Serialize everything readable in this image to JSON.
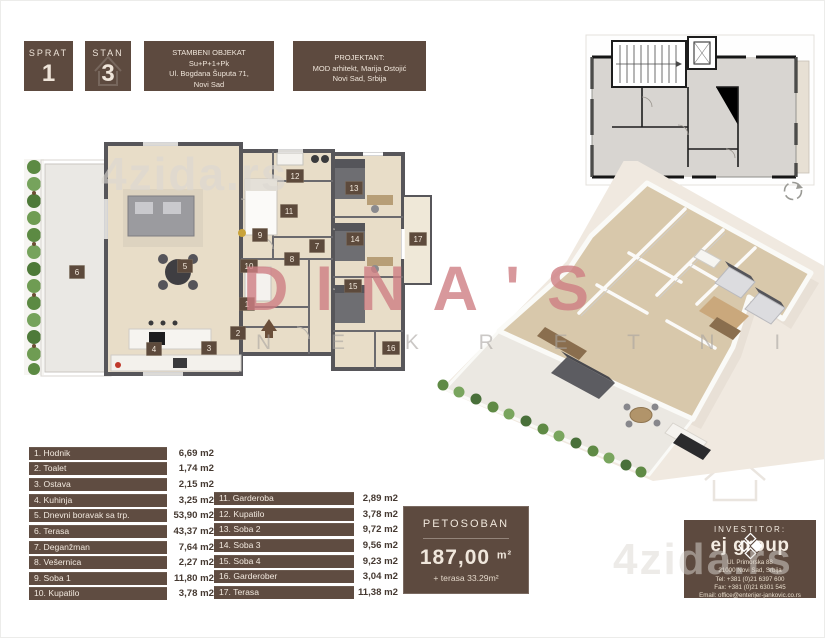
{
  "header": {
    "sprat": {
      "label": "SPRAT",
      "value": "1"
    },
    "stan": {
      "label": "STAN",
      "value": "3"
    },
    "object": {
      "line1": "STAMBENI OBJEKAT",
      "line2": "Su+P+1+Pk",
      "line3": "Ul. Bogdana Šuputa 71,",
      "line4": "Novi Sad"
    },
    "projektant": {
      "line1": "PROJEKTANT:",
      "line2": "MOD arhitekt, Marija Ostojić",
      "line3": "Novi Sad, Srbija"
    }
  },
  "legend": {
    "left": [
      {
        "label": "1. Hodnik",
        "area": "6,69 m2"
      },
      {
        "label": "2. Toalet",
        "area": "1,74 m2"
      },
      {
        "label": "3. Ostava",
        "area": "2,15 m2"
      },
      {
        "label": "4. Kuhinja",
        "area": "3,25 m2"
      },
      {
        "label": "5. Dnevni boravak sa trp.",
        "area": "53,90 m2"
      },
      {
        "label": "6. Terasa",
        "area": "43,37 m2"
      },
      {
        "label": "7. Deganžman",
        "area": "7,64 m2"
      },
      {
        "label": "8. Vešernica",
        "area": "2,27 m2"
      },
      {
        "label": "9. Soba 1",
        "area": "11,80 m2"
      },
      {
        "label": "10. Kupatilo",
        "area": "3,78 m2"
      }
    ],
    "right": [
      {
        "label": "11. Garderoba",
        "area": "2,89 m2"
      },
      {
        "label": "12. Kupatilo",
        "area": "3,78 m2"
      },
      {
        "label": "13. Soba 2",
        "area": "9,72 m2"
      },
      {
        "label": "14. Soba 3",
        "area": "9,56 m2"
      },
      {
        "label": "15. Soba 4",
        "area": "9,23 m2"
      },
      {
        "label": "16. Garderober",
        "area": "3,04 m2"
      },
      {
        "label": "17. Terasa",
        "area": "11,38 m2"
      }
    ]
  },
  "summary": {
    "type_label": "PETOSOBAN",
    "area_value": "187,00",
    "area_unit": "m²",
    "terrace_note": "+ terasa 33.29m²"
  },
  "investor": {
    "title": "INVESTITOR:",
    "brand": "ej group",
    "address": "Ul. Primorska 88",
    "city": "21000 Novi Sad, Srbija",
    "tel": "Tel:  +381 (0)21 6397 600",
    "fax": "Fax:  +381 (0)21 6301 545",
    "email": "Email: office@enterijer-jankovic.co.rs"
  },
  "watermarks": {
    "top": "4zida.rs",
    "brand": "DINA'S",
    "brand_sub": "N E K R E T N I N E",
    "bottom": "4zida.rs"
  },
  "plan2d": {
    "markers": [
      "1",
      "2",
      "3",
      "4",
      "5",
      "6",
      "7",
      "8",
      "9",
      "10",
      "11",
      "12",
      "13",
      "14",
      "15",
      "16",
      "17"
    ]
  },
  "colors": {
    "brown_box": "#5d4a3f",
    "cream_text": "#efe5da",
    "floor_beige": "#e8ddc8",
    "wall_gray": "#57565a",
    "terrace_gray": "#eae8e4",
    "hedge_green": "#6d9150",
    "watermark_red": "#cf7f84",
    "watermark_gray": "#a9a5a1"
  }
}
